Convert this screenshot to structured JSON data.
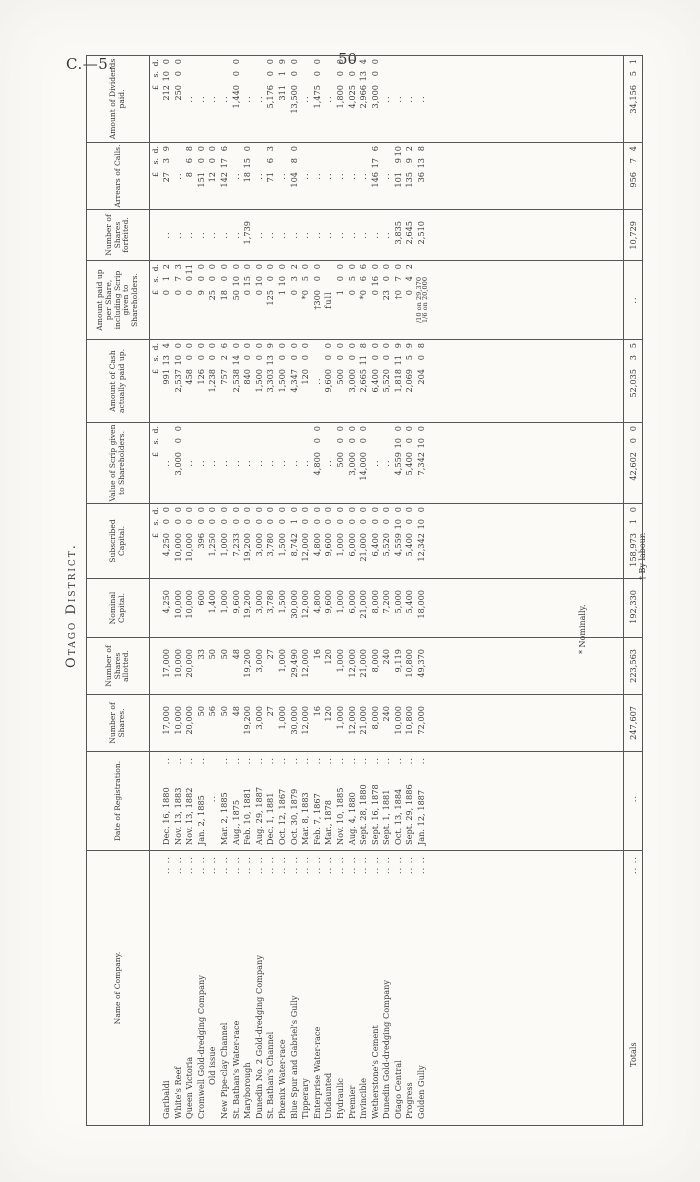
{
  "page": {
    "doc_ref": "C.—5.",
    "page_number": "50",
    "title": "Otago District."
  },
  "colors": {
    "paper": "#fbfaf7",
    "ink": "#3a3a3a",
    "rule": "#565656"
  },
  "table": {
    "columns": [
      "Name of Company.",
      "Date of Registration.",
      "Number of Shares.",
      "Number of Shares allotted.",
      "Nominal Capital.",
      "Subscribed Capital.",
      "Value of Scrip given to Shareholders.",
      "Amount of Cash actually paid up.",
      "Amount paid up per Share, including Scrip given to Shareholders.",
      "Number of Shares forfeited.",
      "Arrears of Calls.",
      "Amount of Dividends paid."
    ],
    "money_subheader": "£ s. d.",
    "rows": [
      {
        "name": "Garibaldi",
        "date": "Dec. 16, 1880",
        "shares": "17,000",
        "allotted": "17,000",
        "nominal": "4,250",
        "subscribed": "4,250 0 0",
        "scrip": "..",
        "cash": "991 13 4",
        "per_share": "0 1 2",
        "forfeited": "..",
        "arrears": "27 3 9",
        "dividends": "212 10 0"
      },
      {
        "name": "White's Reef",
        "date": "Nov. 13, 1883",
        "shares": "10,000",
        "allotted": "10,000",
        "nominal": "10,000",
        "subscribed": "10,000 0 0",
        "scrip": "3,000 0 0",
        "cash": "2,537 10 0",
        "per_share": "0 7 3",
        "forfeited": "..",
        "arrears": "..",
        "dividends": "250 0 0"
      },
      {
        "name": "Queen Victoria",
        "date": "Nov. 13, 1882",
        "shares": "20,000",
        "allotted": "20,000",
        "nominal": "10,000",
        "subscribed": "10,000 0 0",
        "scrip": "..",
        "cash": "458 0 0",
        "per_share": "0 0 11",
        "forfeited": "..",
        "arrears": "8 6 8",
        "dividends": ".."
      },
      {
        "name": "Cromwell Gold-dredging Company",
        "date": "Jan. 2, 1885",
        "shares": "50",
        "allotted": "33",
        "nominal": "600",
        "subscribed": "396 0 0",
        "scrip": "..",
        "cash": "126 0 0",
        "per_share": "9 0 0",
        "forfeited": "..",
        "arrears": "151 0 0",
        "dividends": ".."
      },
      {
        "name": "Old issue",
        "indent": true,
        "date": "..",
        "shares": "56",
        "allotted": "50",
        "nominal": "1,400",
        "subscribed": "1,250 0 0",
        "scrip": "..",
        "cash": "1,238 0 0",
        "per_share": "25 0 0",
        "forfeited": "..",
        "arrears": "12 0 0",
        "dividends": ".."
      },
      {
        "name": "New Pipe-clay Channel",
        "date": "Mar. 2, 1885",
        "shares": "50",
        "allotted": "50",
        "nominal": "1,000",
        "subscribed": "1,000 0 0",
        "scrip": "..",
        "cash": "757 2 6",
        "per_share": "18 0 0",
        "forfeited": "..",
        "arrears": "142 17 6",
        "dividends": ".."
      },
      {
        "name": "St. Bathan's Water-race",
        "date": "Aug., 1875",
        "shares": "48",
        "allotted": "48",
        "nominal": "9,600",
        "subscribed": "7,233 0 0",
        "scrip": "..",
        "cash": "2,538 14 0",
        "per_share": "50 10 0",
        "forfeited": "..",
        "arrears": "..",
        "dividends": "1,440 0 0"
      },
      {
        "name": "Maryborough",
        "date": "Feb. 10, 1881",
        "shares": "19,200",
        "allotted": "19,200",
        "nominal": "19,200",
        "subscribed": "19,200 0 0",
        "scrip": "..",
        "cash": "840 0 0",
        "per_share": "0 15 0",
        "forfeited": "1,739",
        "arrears": "18 15 0",
        "dividends": ".."
      },
      {
        "name": "Dunedin No. 2 Gold-dredging Company",
        "date": "Aug. 29, 1887",
        "shares": "3,000",
        "allotted": "3,000",
        "nominal": "3,000",
        "subscribed": "3,000 0 0",
        "scrip": "..",
        "cash": "1,500 0 0",
        "per_share": "0 10 0",
        "forfeited": "..",
        "arrears": "..",
        "dividends": ".."
      },
      {
        "name": "St. Bathan's Channel",
        "date": "Dec. 1, 1881",
        "shares": "27",
        "allotted": "27",
        "nominal": "3,780",
        "subscribed": "3,780 0 0",
        "scrip": "..",
        "cash": "3,303 13 9",
        "per_share": "125 0 0",
        "forfeited": "..",
        "arrears": "71 6 3",
        "dividends": "5,176 0 0"
      },
      {
        "name": "Phœnix Water-race",
        "date": "Oct. 12, 1867",
        "shares": "1,000",
        "allotted": "1,000",
        "nominal": "1,500",
        "subscribed": "1,500 0 0",
        "scrip": "..",
        "cash": "1,500 0 0",
        "per_share": "1 10 0",
        "forfeited": "..",
        "arrears": "..",
        "dividends": "311 1 9"
      },
      {
        "name": "Blue Spur and Gabriel's Gully",
        "date": "Oct. 30, 1879",
        "shares": "30,000",
        "allotted": "29,490",
        "nominal": "30,000",
        "subscribed": "8,742 1 0",
        "scrip": "..",
        "cash": "4,347 0 0",
        "per_share": "0 3 2",
        "forfeited": "..",
        "arrears": "104 8 0",
        "dividends": "13,500 0 0"
      },
      {
        "name": "Tipperary",
        "date": "Mar. 8, 1883",
        "shares": "12,000",
        "allotted": "12,000",
        "nominal": "12,000",
        "subscribed": "12,000 0 0",
        "scrip": "..",
        "cash": "120 0 0",
        "per_share": "*0 5 0",
        "forfeited": "..",
        "arrears": "..",
        "dividends": ".."
      },
      {
        "name": "Enterprise Water-race",
        "date": "Feb. 7, 1867",
        "shares": "16",
        "allotted": "16",
        "nominal": "4,800",
        "subscribed": "4,800 0 0",
        "scrip": "4,800 0 0",
        "cash": "..",
        "per_share": "†300 0 0",
        "forfeited": "..",
        "arrears": "..",
        "dividends": "1,475 0 0"
      },
      {
        "name": "Undaunted",
        "date": "Mar., 1878",
        "shares": "120",
        "allotted": "120",
        "nominal": "9,600",
        "subscribed": "9,600 0 0",
        "scrip": "..",
        "cash": "9,600 0 0",
        "per_share": "full",
        "forfeited": "..",
        "arrears": "..",
        "dividends": ".."
      },
      {
        "name": "Hydraulic",
        "date": "Nov. 10, 1885",
        "shares": "1,000",
        "allotted": "1,000",
        "nominal": "1,000",
        "subscribed": "1,000 0 0",
        "scrip": "500 0 0",
        "cash": "500 0 0",
        "per_share": "1 0 0",
        "forfeited": "..",
        "arrears": "..",
        "dividends": "1,800 0 0"
      },
      {
        "name": "Premier",
        "date": "Aug. 4, 1880",
        "shares": "12,000",
        "allotted": "12,000",
        "nominal": "6,000",
        "subscribed": "6,000 0 0",
        "scrip": "3,000 0 0",
        "cash": "3,000 0 0",
        "per_share": "0 5 0",
        "forfeited": "..",
        "arrears": "..",
        "dividends": "4,025 0 0"
      },
      {
        "name": "Invincible",
        "date": "Sept. 28, 1880",
        "shares": "21,000",
        "allotted": "21,000",
        "nominal": "21,000",
        "subscribed": "21,000 0 0",
        "scrip": "14,000 0 0",
        "cash": "2,665 11 8",
        "per_share": "*0 6 6",
        "forfeited": "..",
        "arrears": "..",
        "dividends": "2,966 13 4"
      },
      {
        "name": "Wetherstone's Cement",
        "date": "Sept. 16, 1878",
        "shares": "8,000",
        "allotted": "8,000",
        "nominal": "8,000",
        "subscribed": "6,400 0 0",
        "scrip": "..",
        "cash": "6,400 0 0",
        "per_share": "0 16 0",
        "forfeited": "..",
        "arrears": "146 17 6",
        "dividends": "3,000 0 0"
      },
      {
        "name": "Dunedin Gold-dredging Company",
        "date": "Sept. 1, 1881",
        "shares": "240",
        "allotted": "240",
        "nominal": "7,200",
        "subscribed": "5,520 0 0",
        "scrip": "..",
        "cash": "5,520 0 0",
        "per_share": "23 0 0",
        "forfeited": "..",
        "arrears": "..",
        "dividends": ".."
      },
      {
        "name": "Otago Central",
        "date": "Oct. 13, 1884",
        "shares": "10,000",
        "allotted": "9,119",
        "nominal": "5,000",
        "subscribed": "4,559 10 0",
        "scrip": "4,559 10 0",
        "cash": "1,818 11 9",
        "per_share": "†0 7 0",
        "forfeited": "3,835",
        "arrears": "101 9 10",
        "dividends": ".."
      },
      {
        "name": "Progress",
        "date": "Sept. 29, 1886",
        "shares": "10,800",
        "allotted": "10,800",
        "nominal": "5,400",
        "subscribed": "5,400 0 0",
        "scrip": "5,400 0 0",
        "cash": "2,069 5 9",
        "per_share": "0 4 2",
        "forfeited": "2,645",
        "arrears": "135 9 2",
        "dividends": ".."
      },
      {
        "name": "Golden Gully",
        "date": "Jan. 12, 1887",
        "shares": "72,000",
        "allotted": "49,370",
        "nominal": "18,000",
        "subscribed": "12,342 10 0",
        "scrip": "7,342 10 0",
        "cash": "204 0 8",
        "per_share": "/10 on 29,370\n1/6 on 20,000",
        "forfeited": "2,510",
        "arrears": "36 13 8",
        "dividends": ".."
      }
    ],
    "totals": {
      "name": "Totals",
      "date": "..",
      "shares": "247,607",
      "allotted": "223,563",
      "nominal": "192,330",
      "subscribed": "158,973 1 0",
      "scrip": "42,602 0 0",
      "cash": "52,035 3 5",
      "per_share": "..",
      "forfeited": "10,729",
      "arrears": "956 7 4",
      "dividends": "34,156 5 1"
    },
    "footnotes": [
      "* Nominally.",
      "† By labour."
    ]
  }
}
